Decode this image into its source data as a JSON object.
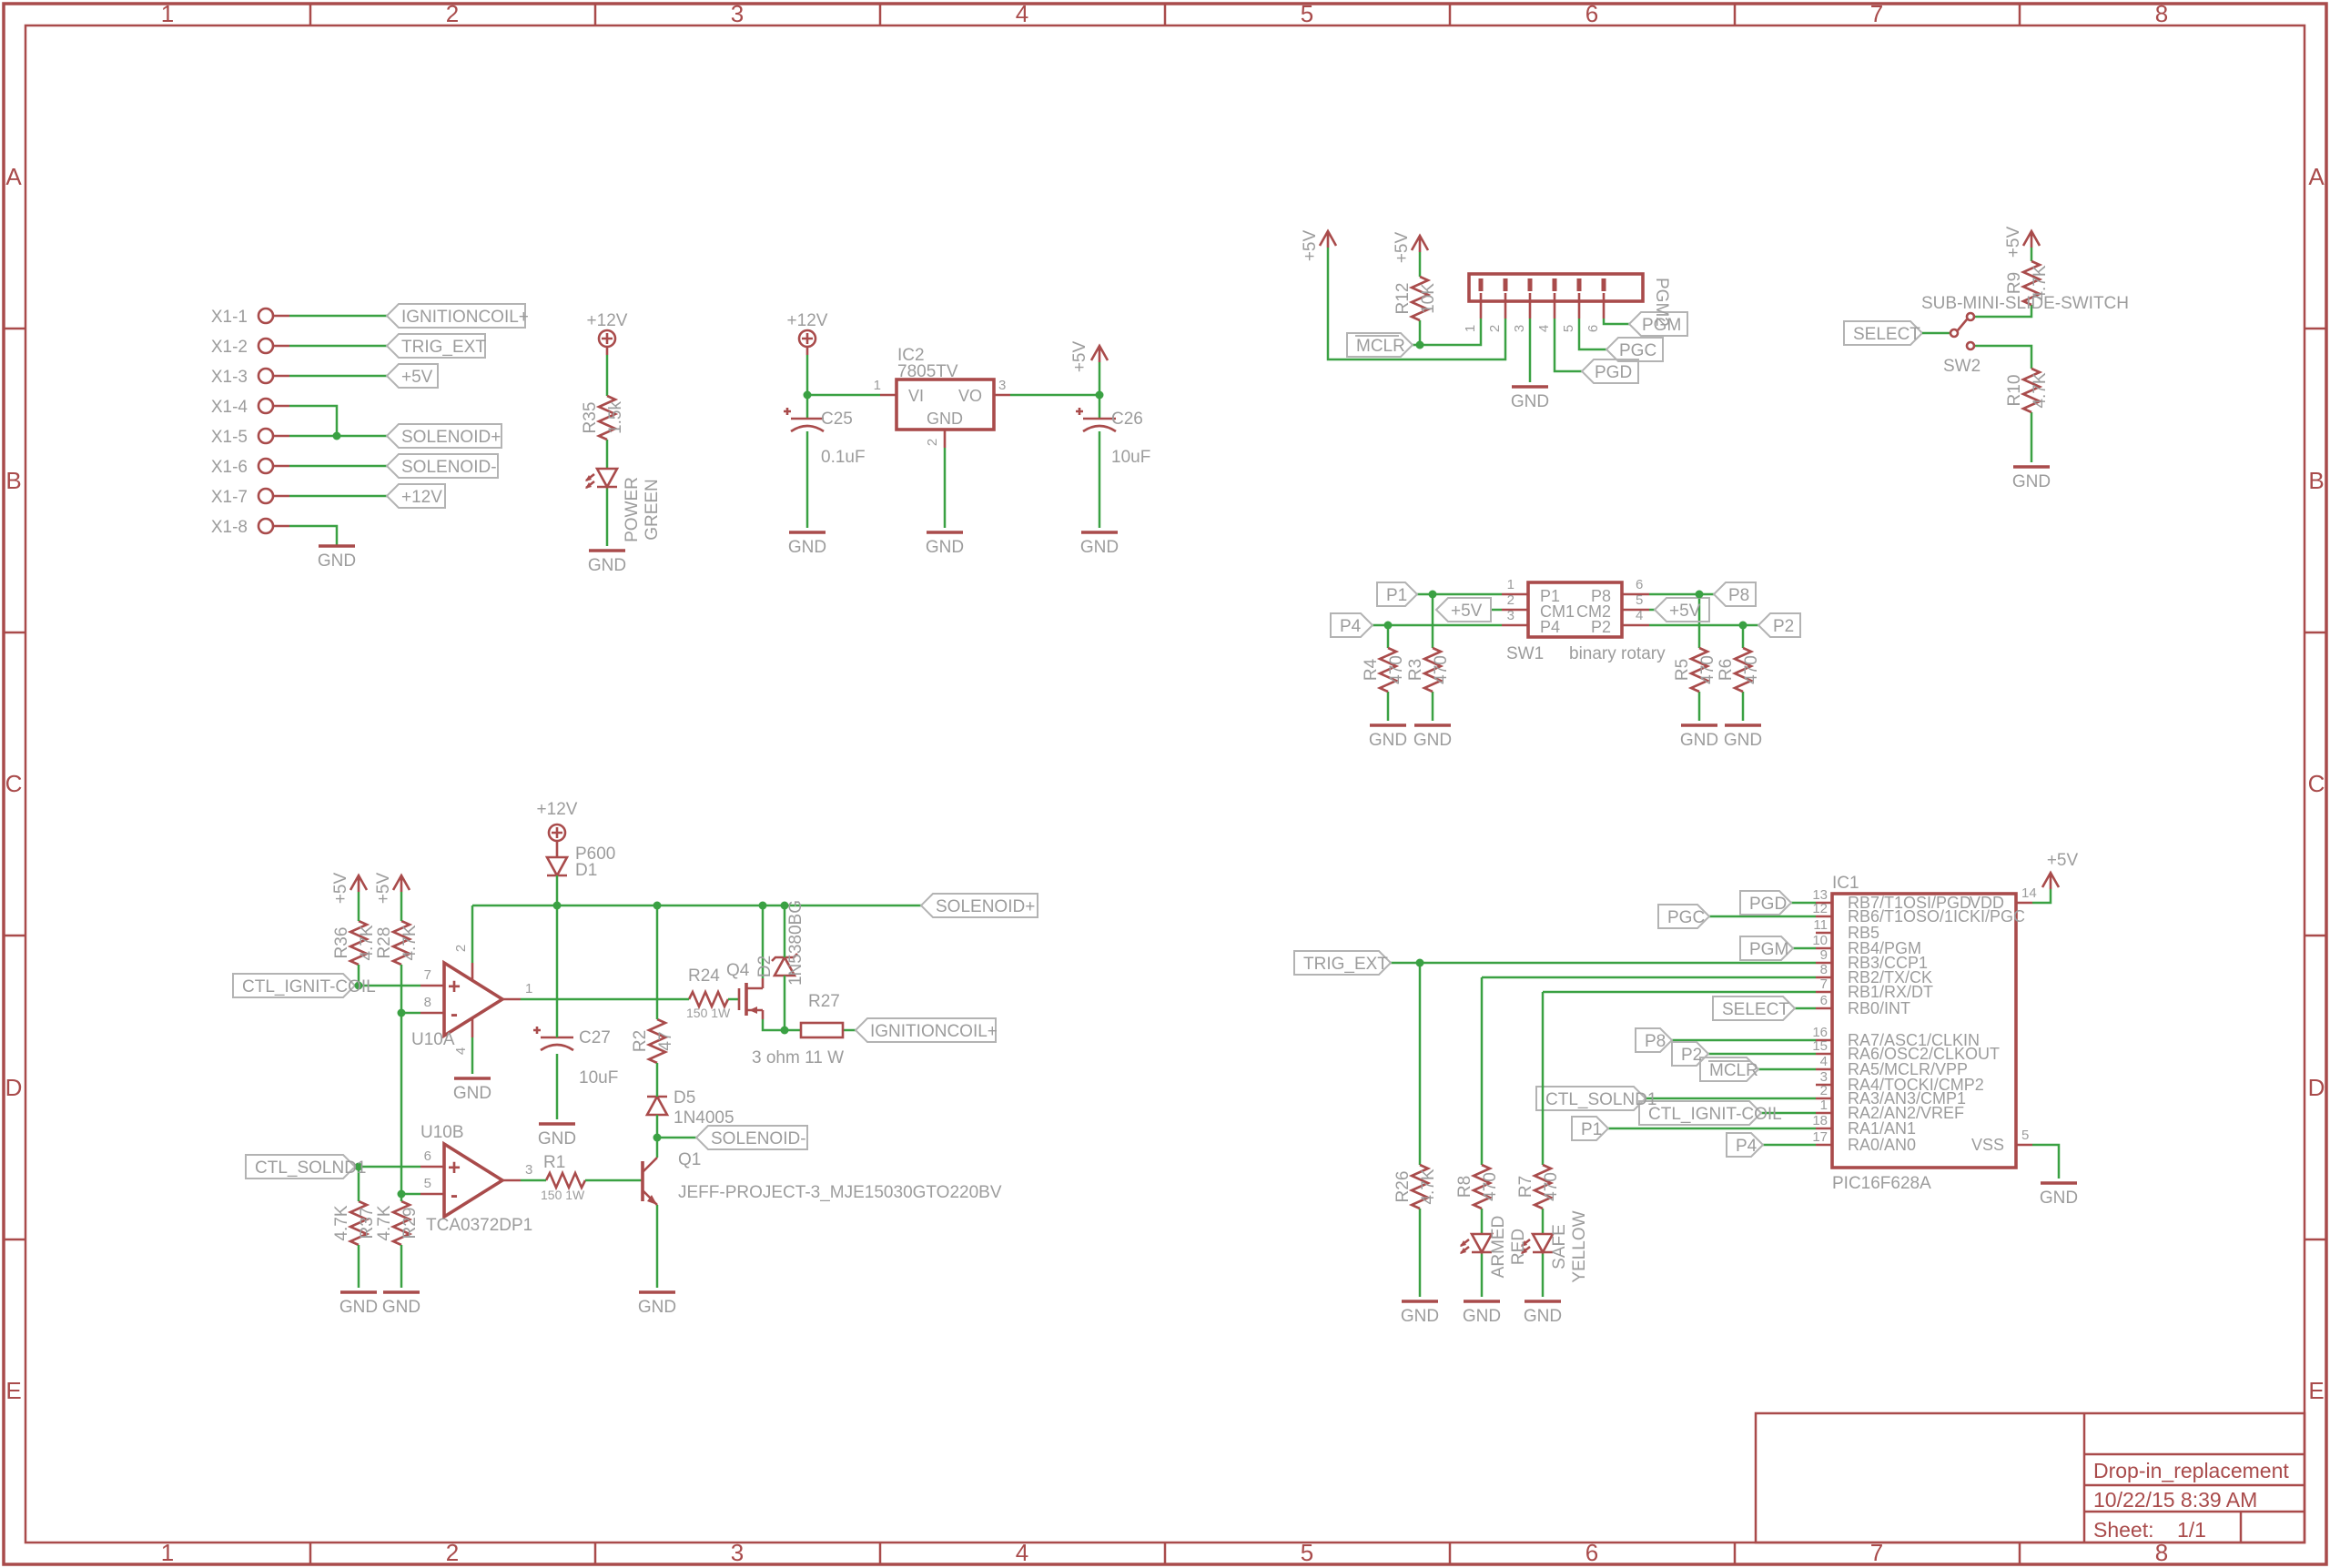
{
  "palette": {
    "frame_red": "#a94b4b",
    "symbol_red": "#a94b4b",
    "wire_green": "#3aa143",
    "label_gray": "#9c9c9c",
    "flag_outline": "#b3b3b3",
    "background": "#ffffff"
  },
  "border": {
    "columns": [
      "1",
      "2",
      "3",
      "4",
      "5",
      "6",
      "7",
      "8"
    ],
    "rows": [
      "A",
      "B",
      "C",
      "D",
      "E"
    ]
  },
  "title_block": {
    "title": "Drop-in_replacement",
    "date": "10/22/15 8:39 AM",
    "sheet_label": "Sheet:",
    "sheet_value": "1/1"
  },
  "connector": {
    "pins": [
      {
        "name": "X1-1",
        "net": "IGNITIONCOIL+"
      },
      {
        "name": "X1-2",
        "net": "TRIG_EXT"
      },
      {
        "name": "X1-3",
        "net": "+5V"
      },
      {
        "name": "X1-4",
        "net": ""
      },
      {
        "name": "X1-5",
        "net": "SOLENOID+"
      },
      {
        "name": "X1-6",
        "net": "SOLENOID-"
      },
      {
        "name": "X1-7",
        "net": "+12V"
      },
      {
        "name": "X1-8",
        "net": ""
      }
    ],
    "gnd": "GND"
  },
  "power_led": {
    "supply": "+12V",
    "r": "R35",
    "rv": "1.5k",
    "led1": "POWER",
    "led2": "GREEN",
    "gnd": "GND"
  },
  "regulator": {
    "supply": "+12V",
    "ic": "IC2",
    "part": "7805TV",
    "vi": "VI",
    "vo": "VO",
    "gnd_pin": "GND",
    "p1": "1",
    "p2": "2",
    "p3": "3",
    "cin": "C25",
    "cinv": "0.1uF",
    "cout": "C26",
    "coutv": "10uF",
    "out": "+5V",
    "gnd": "GND"
  },
  "pgm2": {
    "name": "PGM2",
    "pins": [
      "1",
      "2",
      "3",
      "4",
      "5",
      "6"
    ],
    "r": "R12",
    "rv": "10K",
    "vcc": "+5V",
    "mclr": "MCLR",
    "pgd": "PGD",
    "pgc": "PGC",
    "pgm": "PGM",
    "gnd": "GND"
  },
  "slide_switch": {
    "name": "SW2",
    "part": "SUB-MINI-SLIDE-SWITCH",
    "net": "SELECT",
    "r_up": "R9",
    "r_up_v": "4.7K",
    "r_dn": "R10",
    "r_dn_v": "4.7K",
    "vcc": "+5V",
    "gnd": "GND"
  },
  "rotary": {
    "name": "SW1",
    "part": "binary rotary",
    "pins_l": [
      "1",
      "2",
      "3"
    ],
    "pins_r": [
      "6",
      "5",
      "4"
    ],
    "inside_l": [
      "P1",
      "CM1",
      "P4"
    ],
    "inside_r": [
      "P8",
      "CM2",
      "P2"
    ],
    "flags_l": [
      "P1",
      "+5V",
      "P4"
    ],
    "flags_r": [
      "P8",
      "+5V",
      "P2"
    ],
    "res": [
      {
        "n": "R4",
        "v": "470"
      },
      {
        "n": "R3",
        "v": "470"
      },
      {
        "n": "R5",
        "v": "470"
      },
      {
        "n": "R6",
        "v": "470"
      }
    ],
    "gnd": "GND"
  },
  "driver": {
    "vcc": "+5V",
    "vcc12": "+12V",
    "r36": "R36",
    "r36v": "4.7K",
    "r28": "R28",
    "r28v": "4.7K",
    "in1": "CTL_IGNIT-COIL",
    "in2": "CTL_SOLND1",
    "oa": "U10A",
    "ob": "U10B",
    "oa_part": "TCA0372DP1",
    "p7": "7",
    "p8": "8",
    "p1": "1",
    "p2": "2",
    "p4": "4",
    "p6": "6",
    "p5": "5",
    "p3": "3",
    "plus": "+",
    "minus": "-",
    "d1": "D1",
    "d1p": "P600",
    "c27": "C27",
    "c27v": "10uF",
    "r24": "R24",
    "r24v": "150 1W",
    "r2": "R2",
    "r2v": "47",
    "q4": "Q4",
    "d2": "D2",
    "d2p": "1N5380BG",
    "r27": "R27",
    "r27v": "3 ohm 11 W",
    "sol_p": "SOLENOID+",
    "sol_m": "SOLENOID-",
    "ign": "IGNITIONCOIL+",
    "d5": "D5",
    "d5p": "1N4005",
    "r37": "R37",
    "r37v": "4.7K",
    "r29": "R29",
    "r29v": "4.7K",
    "r1": "R1",
    "r1v": "150 1W",
    "q1": "Q1",
    "q1p": "JEFF-PROJECT-3_MJE15030GTO220BV",
    "gnd": "GND"
  },
  "mcu": {
    "ic": "IC1",
    "part": "PIC16F628A",
    "vdd": "VDD",
    "vss": "VSS",
    "p14": "14",
    "p5": "5",
    "vcc": "+5V",
    "gnd": "GND",
    "rows": [
      {
        "n": "13",
        "name": "RB7/T1OSI/PGD",
        "flag": "PGD"
      },
      {
        "n": "12",
        "name": "RB6/T1OSO/1ICKI/PGC",
        "flag": "PGC"
      },
      {
        "n": "11",
        "name": "RB5"
      },
      {
        "n": "10",
        "name": "RB4/PGM",
        "flag": "PGM"
      },
      {
        "n": "9",
        "name": "RB3/CCP1"
      },
      {
        "n": "8",
        "name": "RB2/TX/CK"
      },
      {
        "n": "7",
        "name": "RB1/RX/DT"
      },
      {
        "n": "6",
        "name": "RB0/INT",
        "flag": "SELECT"
      },
      {
        "n": "16",
        "name": "RA7/ASC1/CLKIN",
        "flag": "P8"
      },
      {
        "n": "15",
        "name": "RA6/OSC2/CLKOUT",
        "flag": "P2"
      },
      {
        "n": "4",
        "name": "RA5/MCLR/VPP",
        "flag": "MCLR"
      },
      {
        "n": "3",
        "name": "RA4/TOCKI/CMP2"
      },
      {
        "n": "2",
        "name": "RA3/AN3/CMP1",
        "flag": "CTL_SOLND1"
      },
      {
        "n": "1",
        "name": "RA2/AN2/VREF",
        "flag": "CTL_IGNIT-COIL"
      },
      {
        "n": "18",
        "name": "RA1/AN1",
        "flag": "P1"
      },
      {
        "n": "17",
        "name": "RA0/AN0",
        "flag": "P4"
      }
    ]
  },
  "indicators": {
    "trig": "TRIG_EXT",
    "r26": "R26",
    "r26v": "4.7K",
    "r8": "R8",
    "r8v": "470",
    "led1a": "ARMED",
    "led1b": "RED",
    "r7": "R7",
    "r7v": "470",
    "led2a": "SAFE",
    "led2b": "YELLOW",
    "gnd": "GND"
  }
}
